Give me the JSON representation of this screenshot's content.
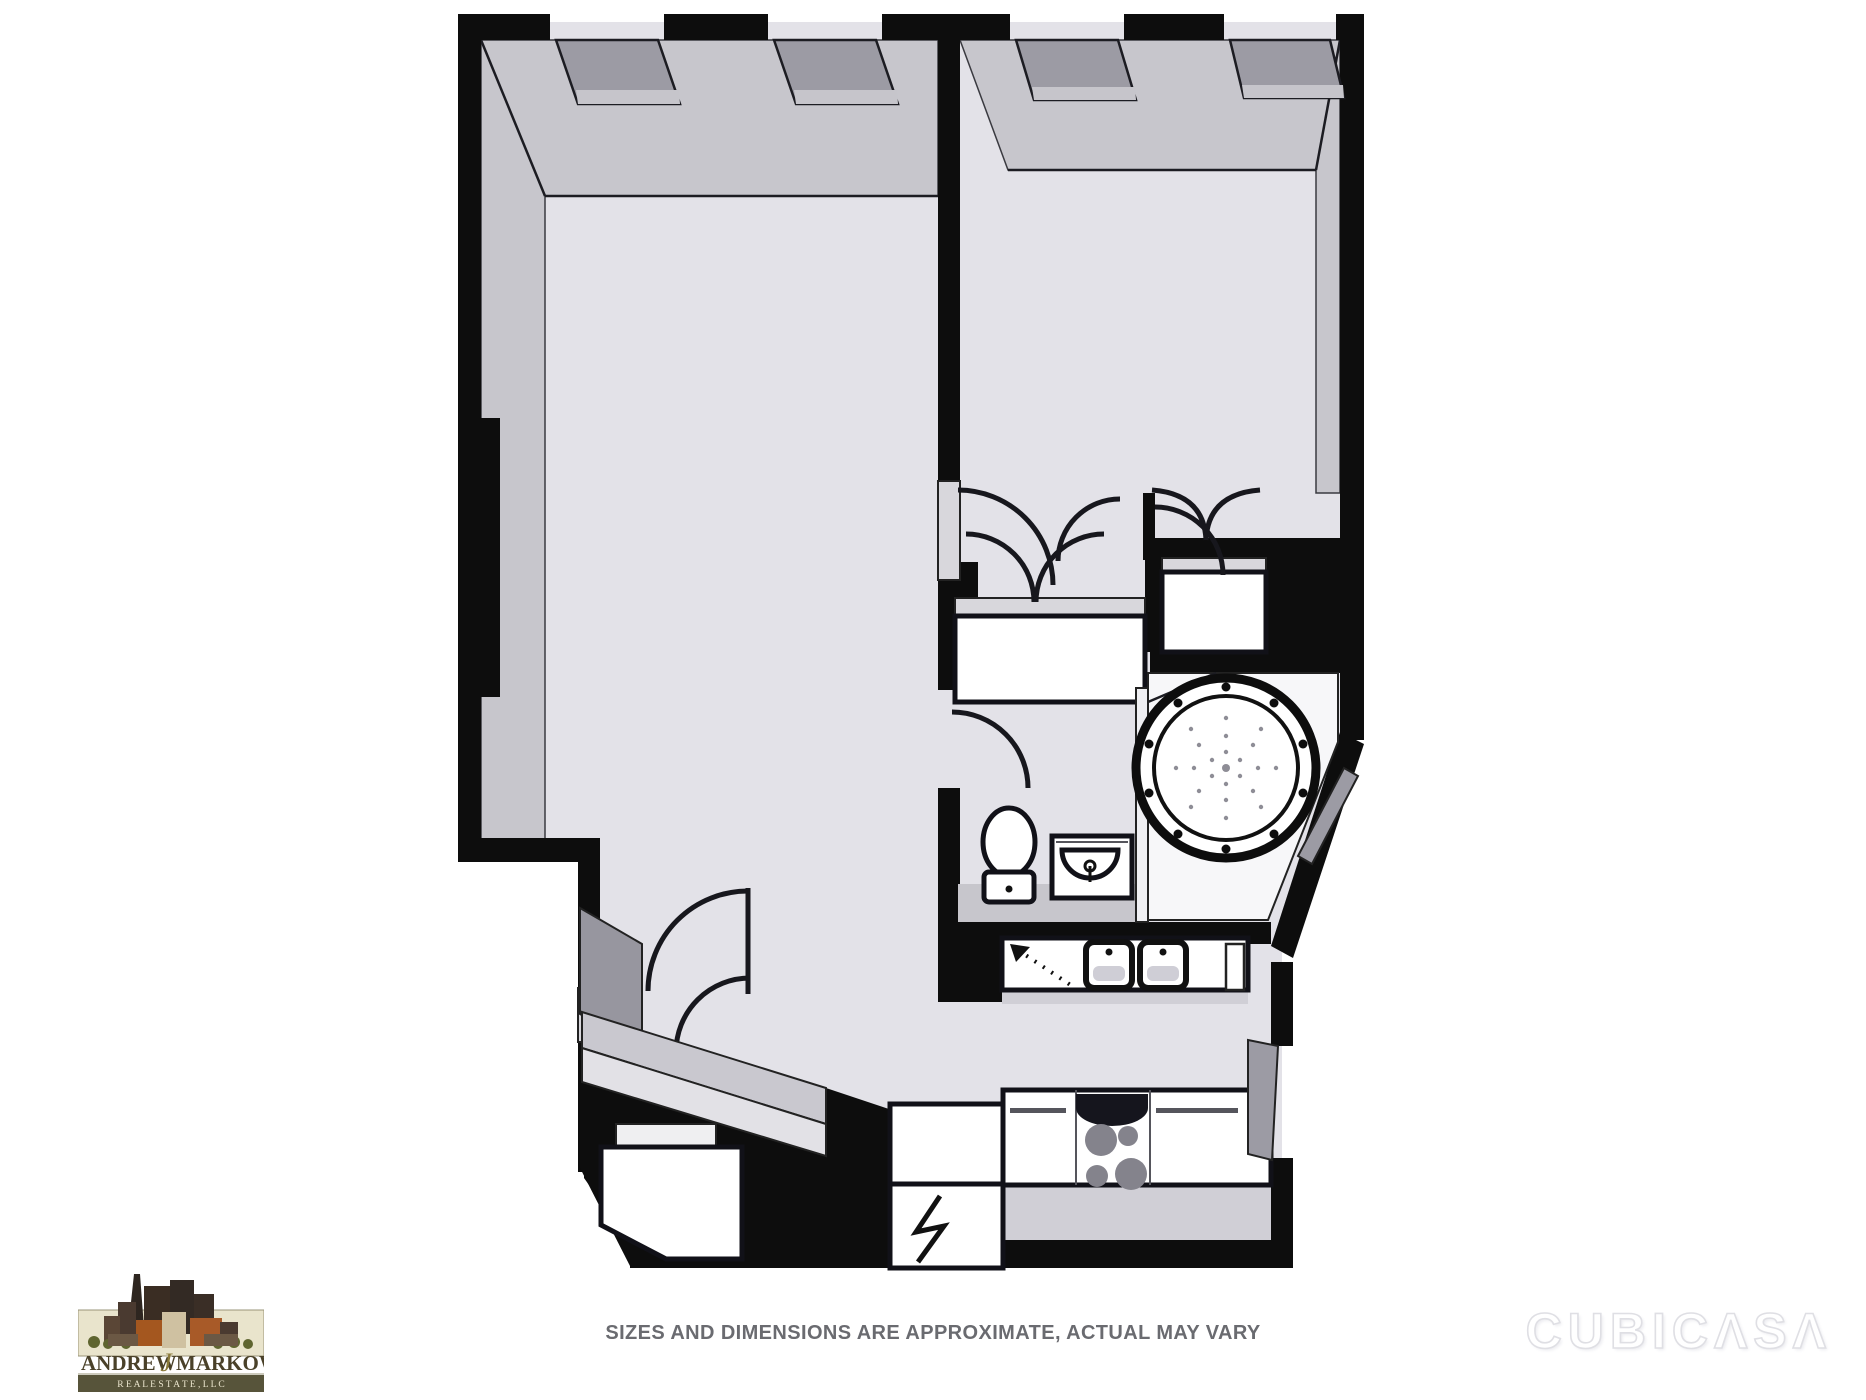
{
  "meta": {
    "type": "floor-plan-marketing-image"
  },
  "colors": {
    "bg": "#ffffff",
    "wall": "#0d0d0d",
    "floor": "#E3E2E8",
    "wallface": "#C7C6CC",
    "wallface-dark": "#97969F",
    "window": "#9C9BA4",
    "sill": "#C6C5CB",
    "fixture": "#ffffff",
    "counter-front": "#D0CFD6",
    "burner": "#84838C",
    "stove-panel": "#15151D",
    "jamb": "#D8D7DC",
    "glass": "#EFEFF2",
    "nook": "#F7F7F9",
    "disclaimer": "#6A6B70",
    "watermark": "#FFFFFF",
    "watermark-outline": "#DFDFE4",
    "logo-beige": "#E9E4CC",
    "logo-olive": "#57543A",
    "logo-text": "#4A4129",
    "logo-rust": "#A4571F",
    "logo-brown": "#3A2D23",
    "logo-tan": "#CFC1A1",
    "logo-green": "#5F6530"
  },
  "floorplan": {
    "style": "pseudo-3D black and white apartment plan",
    "rooms": [
      "living-room",
      "bedroom",
      "hallway-closets",
      "bathroom",
      "kitchen",
      "entry"
    ],
    "window_count": 4,
    "fixtures": [
      "window-bay",
      "window-bay",
      "window-bay",
      "window-bay",
      "closet-double-doors",
      "hall-closet-double-doors",
      "interior-doors-with-swing-arcs",
      "toilet",
      "vanity-sink",
      "round-jetted-tub",
      "glass-partition",
      "kitchen-sink",
      "kitchen-sink",
      "dishwasher",
      "stove-four-burners",
      "refrigerator",
      "entry-steps",
      "entry-closet"
    ]
  },
  "footer": {
    "disclaimer": "SIZES AND DIMENSIONS ARE APPROXIMATE, ACTUAL MAY VARY",
    "watermark": "CUBICΛSΛ",
    "logo": {
      "name_left": "Andrew",
      "name_script": "J",
      "name_right": "Markowitz",
      "subtitle": "R E A L   E S T A T E ,   L L C"
    }
  }
}
